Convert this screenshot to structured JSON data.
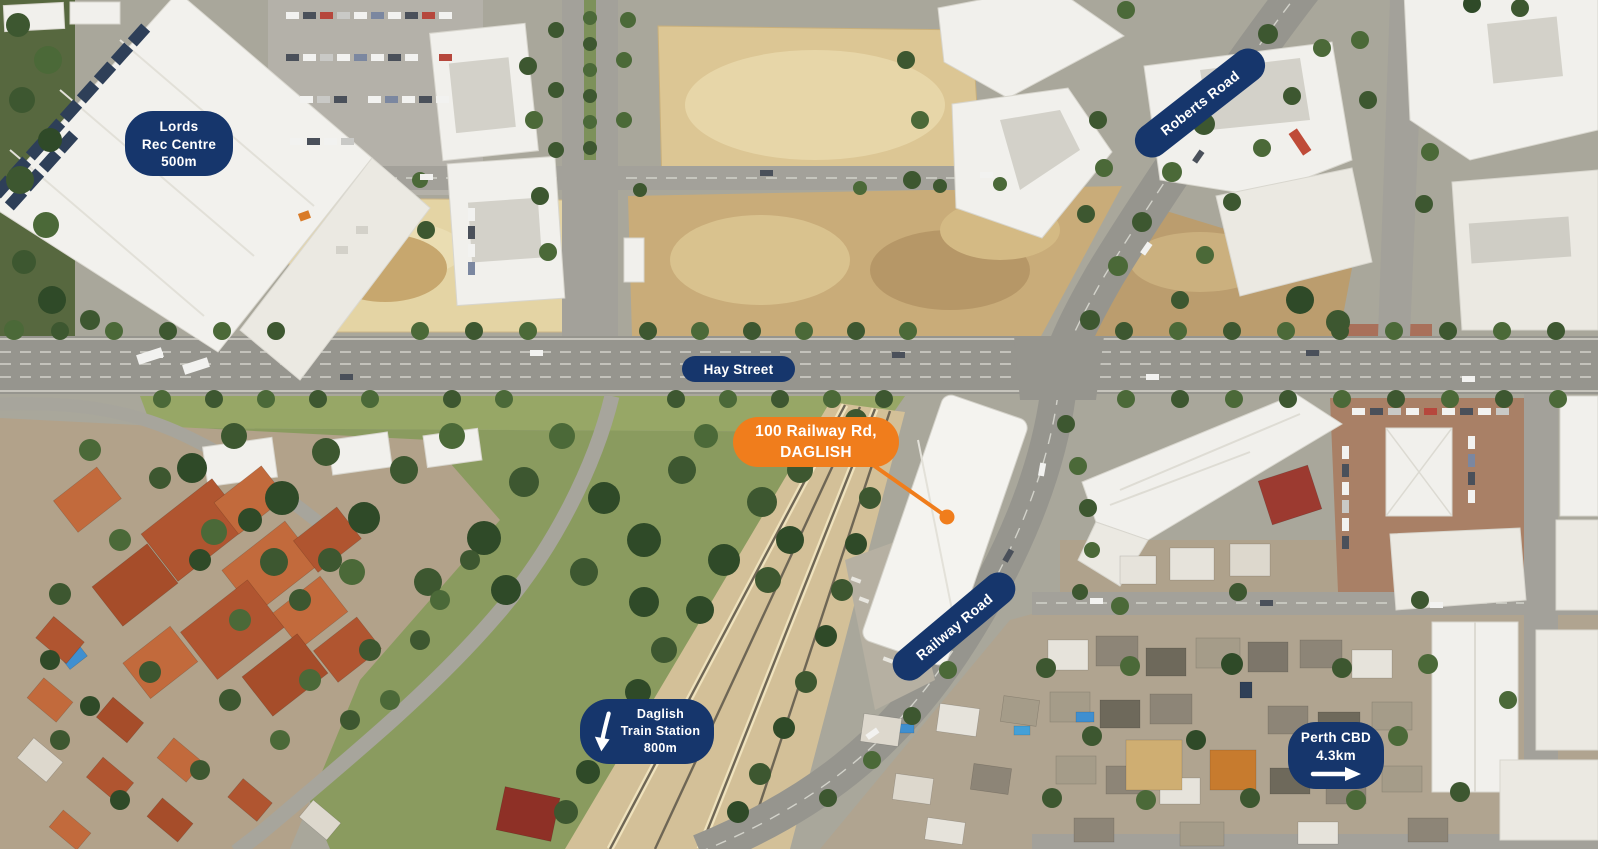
{
  "map": {
    "badges": {
      "lords": {
        "lines": [
          "Lords",
          "Rec Centre",
          "500m"
        ]
      },
      "roberts_road": {
        "label": "Roberts Road"
      },
      "hay_street": {
        "label": "Hay Street"
      },
      "property": {
        "lines": [
          "100 Railway Rd,",
          "DAGLISH"
        ]
      },
      "railway_road": {
        "label": "Railway Road"
      },
      "daglish_station": {
        "lines": [
          "Daglish",
          "Train Station",
          "800m"
        ],
        "arrow": "down-arrow"
      },
      "perth_cbd": {
        "lines": [
          "Perth CBD",
          "4.3km"
        ],
        "arrow": "right-arrow"
      }
    },
    "colors": {
      "navy": "#16366C",
      "orange": "#F07D1C",
      "label_text": "#FFFFFF"
    }
  }
}
